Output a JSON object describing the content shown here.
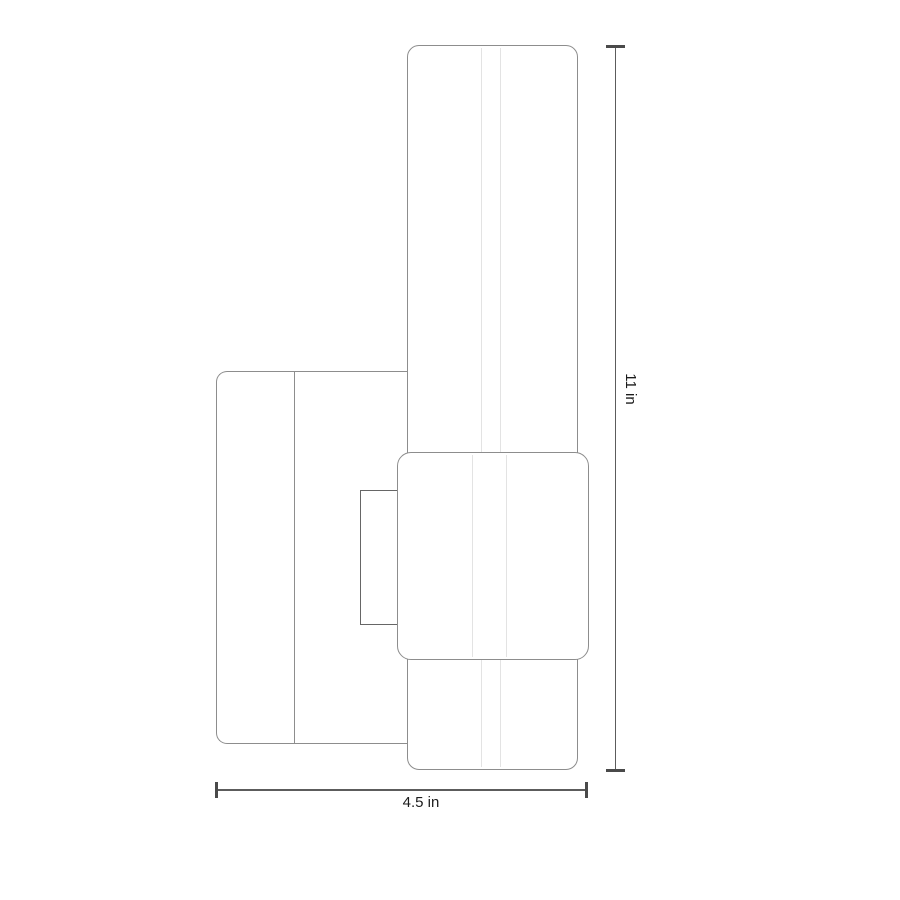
{
  "diagram": {
    "dimensions": {
      "height": {
        "label": "11 in",
        "value": 11,
        "unit": "in"
      },
      "width": {
        "label": "4.5 in",
        "value": 4.5,
        "unit": "in"
      }
    },
    "colors": {
      "background": "#ffffff",
      "fixture_outline": "#8d8d8d",
      "bracket_outline": "#666666",
      "cylinder_highlight": "#e3e3e3",
      "dimension_line": "#5c5c5c",
      "dimension_tick": "#4a4a4a",
      "label_text": "#1c1c1c"
    }
  }
}
